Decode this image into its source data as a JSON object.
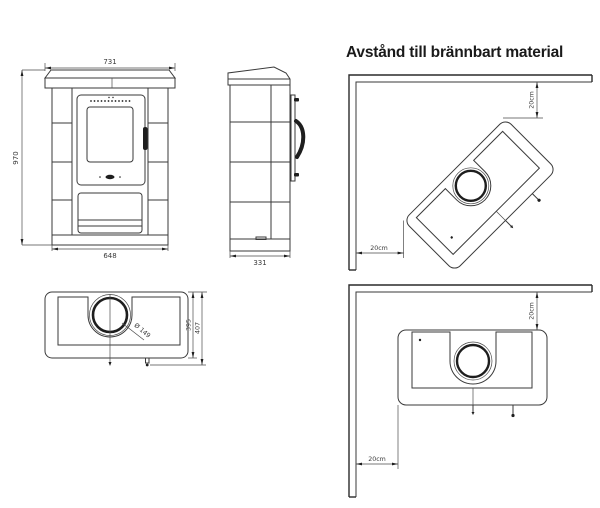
{
  "title": "Avstånd till brännbart material",
  "front_view": {
    "dim_top_width": "731",
    "dim_height": "970",
    "dim_bottom_width": "648"
  },
  "side_view": {
    "dim_depth": "331"
  },
  "top_view": {
    "dim_flue_diameter": "Ø 149",
    "dim_depth_body": "395",
    "dim_depth_total": "407"
  },
  "corner_diagonal": {
    "dim_wall_top": "20cm",
    "dim_wall_left": "20cm"
  },
  "corner_parallel": {
    "dim_wall_top": "20cm",
    "dim_wall_left": "20cm"
  },
  "colors": {
    "line": "#3a3a3a",
    "text": "#3a3a3a",
    "background": "#ffffff",
    "handle_fill": "#1e1e1e"
  }
}
